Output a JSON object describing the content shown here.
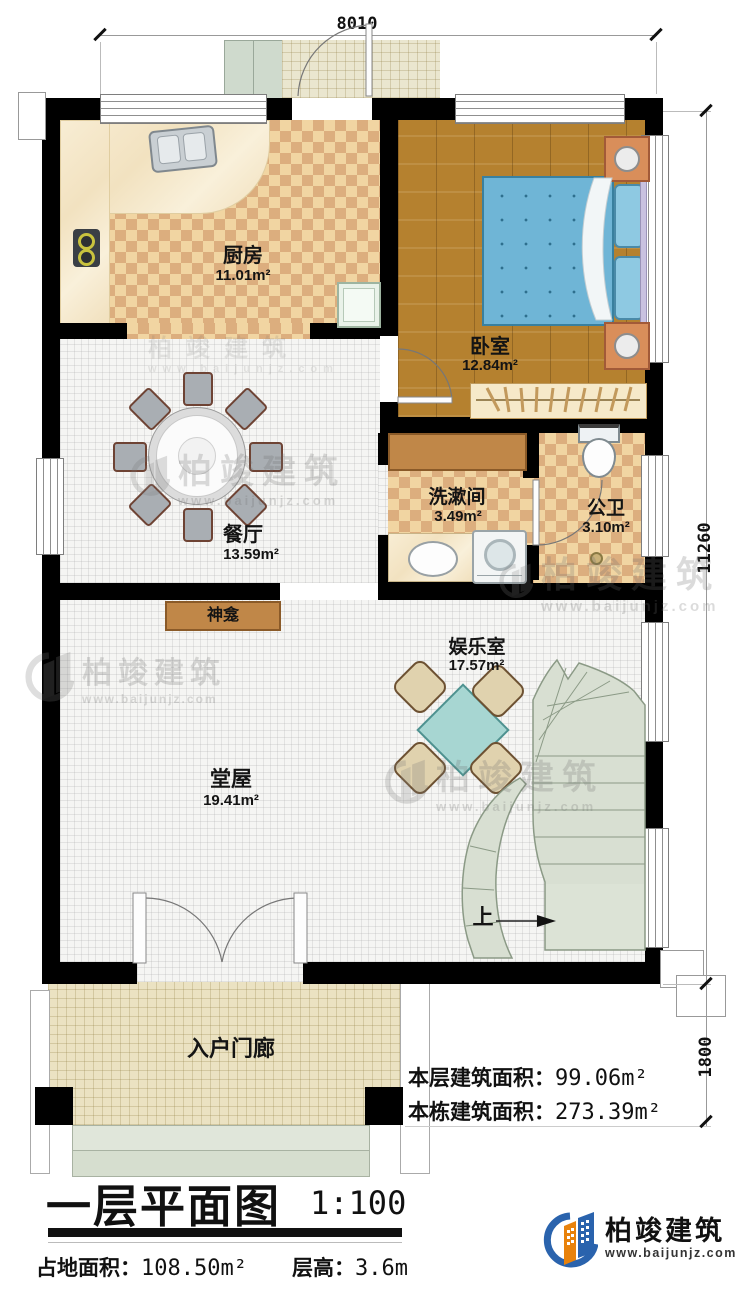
{
  "title": {
    "text": "一层平面图",
    "scale": "1:100"
  },
  "footer": {
    "land_label": "占地面积：",
    "land_value": "108.50m²",
    "height_label": "层高：",
    "height_value": "3.6m"
  },
  "stats": {
    "floor_label": "本层建筑面积：",
    "floor_value": "99.06m²",
    "building_label": "本栋建筑面积：",
    "building_value": "273.39m²"
  },
  "dimensions": {
    "top": "8010",
    "right_upper": "11260",
    "right_lower": "1800"
  },
  "rooms": {
    "kitchen": {
      "name": "厨房",
      "area": "11.01m²"
    },
    "bedroom": {
      "name": "卧室",
      "area": "12.84m²"
    },
    "dining": {
      "name": "餐厅",
      "area": "13.59m²"
    },
    "washroom": {
      "name": "洗漱间",
      "area": "3.49m²"
    },
    "toilet": {
      "name": "公卫",
      "area": "3.10m²"
    },
    "entertainment": {
      "name": "娱乐室",
      "area": "17.57m²"
    },
    "hall": {
      "name": "堂屋",
      "area": "19.41m²"
    },
    "porch": {
      "name": "入户门廊"
    }
  },
  "labels": {
    "shrine": "神龛",
    "stairs_up": "上"
  },
  "logo": {
    "name": "柏竣建筑",
    "website": "www.baijunjz.com"
  },
  "watermark": {
    "name": "柏竣建筑",
    "website": "www.baijunjz.com"
  },
  "colors": {
    "wall": "#000000",
    "checker": "#dcae7e",
    "wood": "#b5812f",
    "bed": "#6fb5d6",
    "stairs": "#d8dfd2",
    "marble": "#f6ead0",
    "porch": "#ebe2c2",
    "cabinet": "#c08748",
    "logo_blue": "#2a63ad",
    "logo_orange": "#e8820c"
  }
}
